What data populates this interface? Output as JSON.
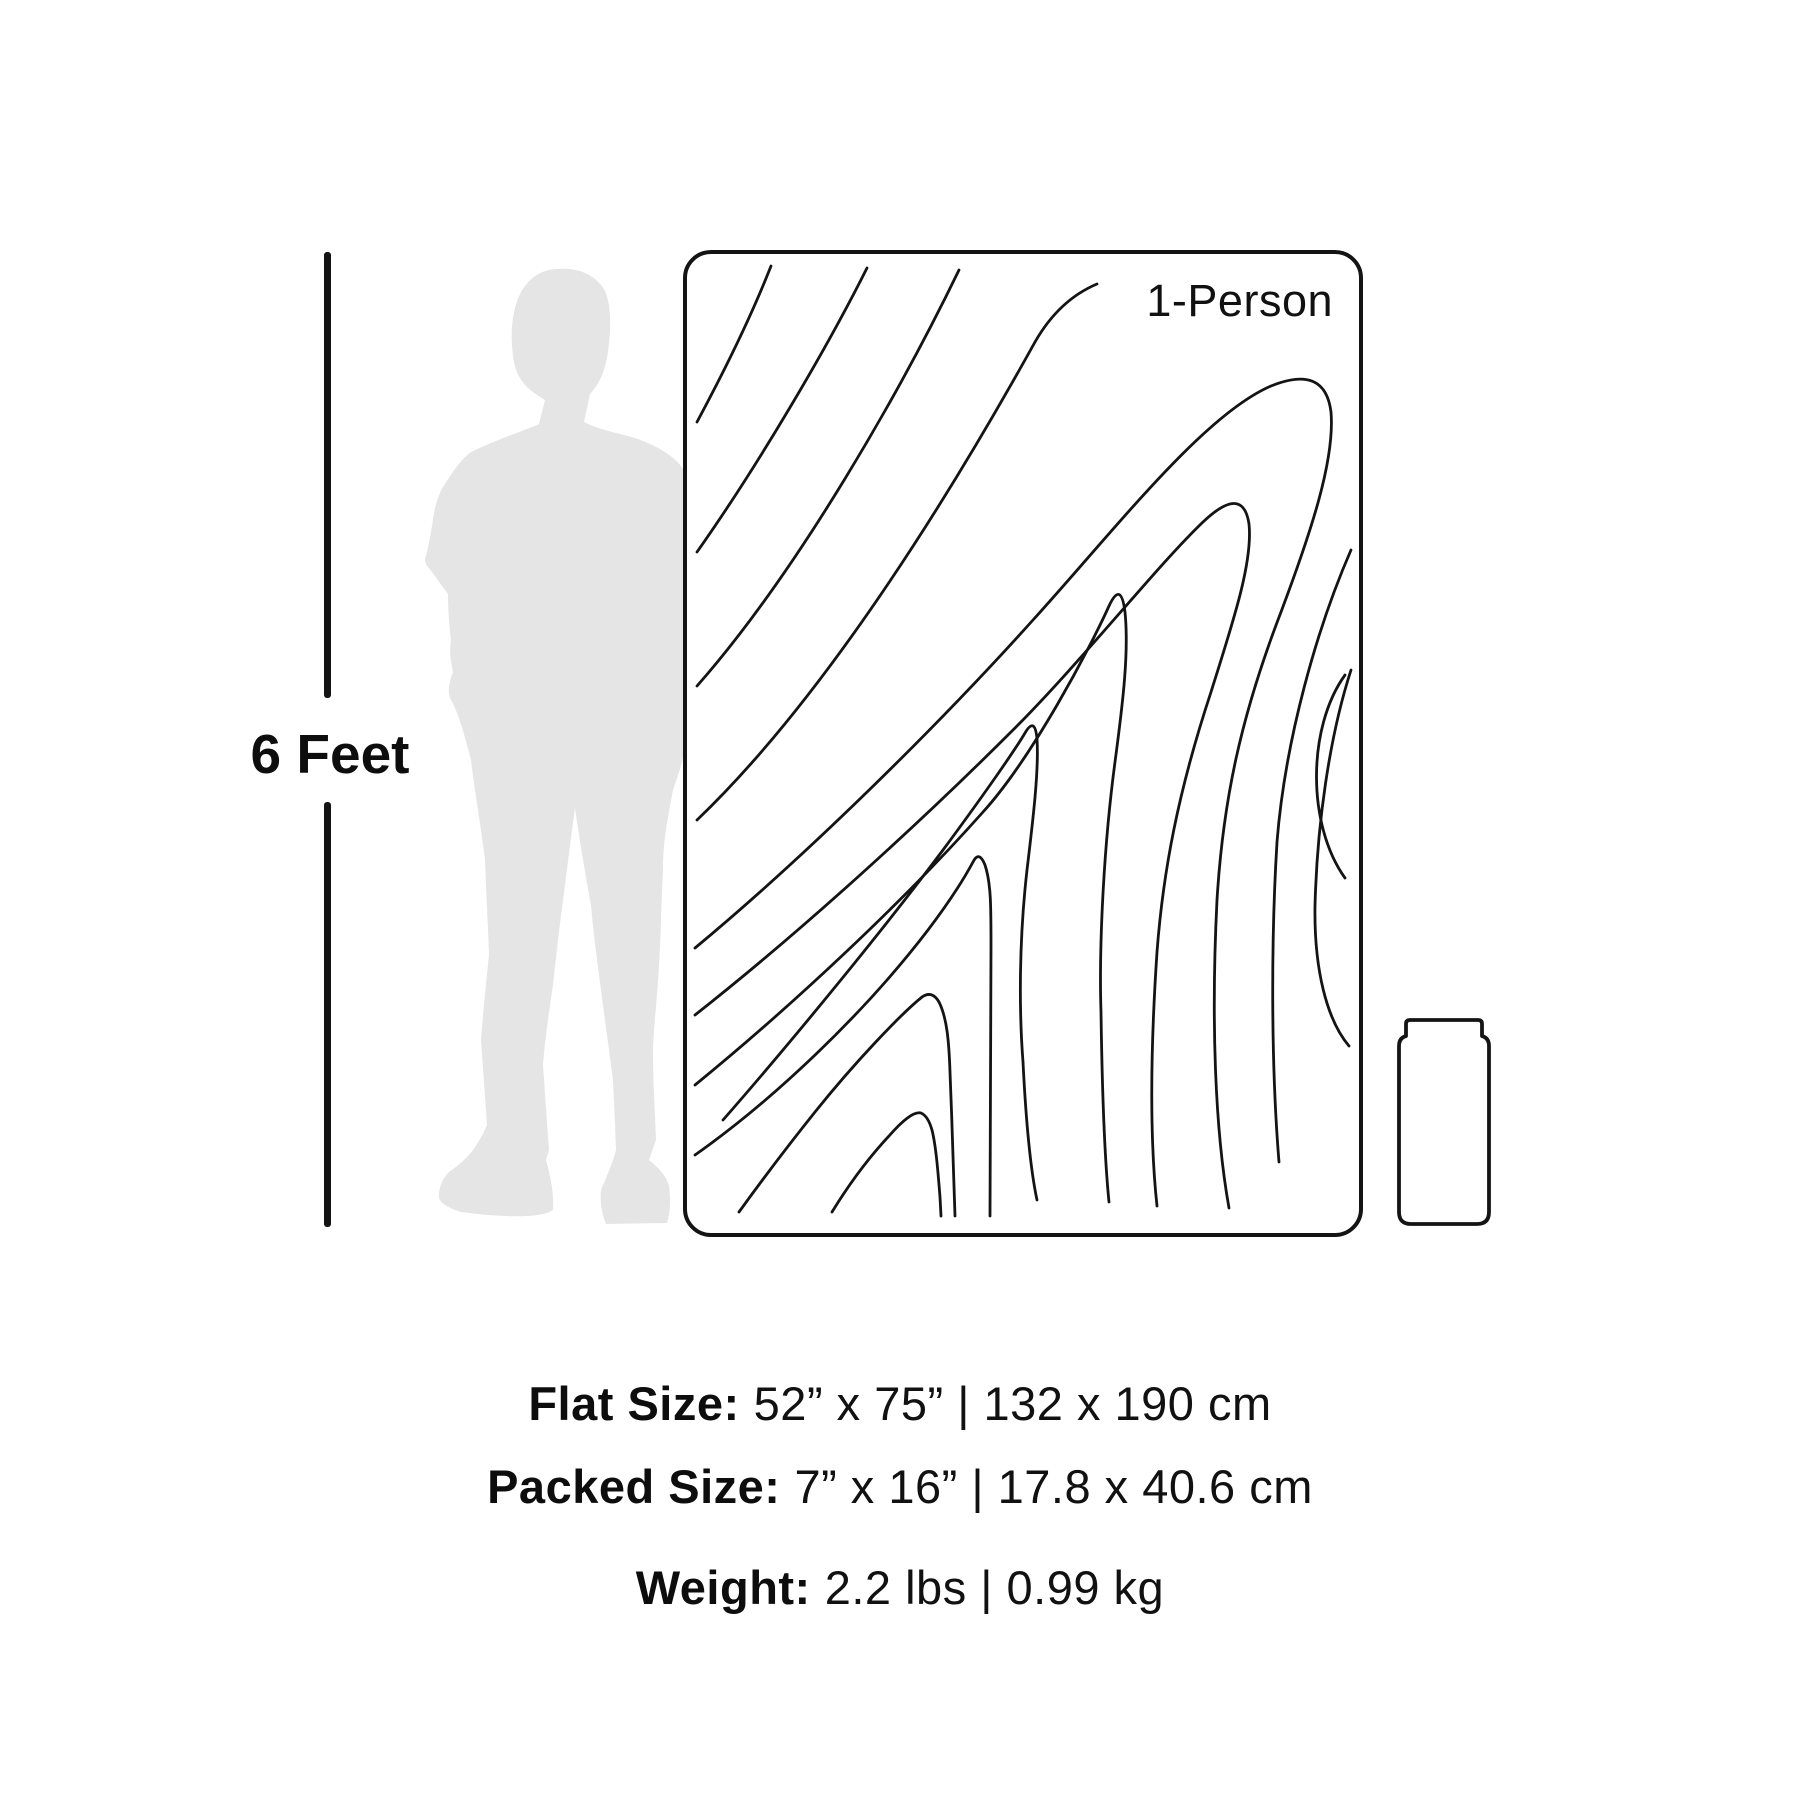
{
  "scale": {
    "label": "6 Feet"
  },
  "blanket": {
    "label": "1-Person"
  },
  "specs": [
    {
      "label": "Flat Size:",
      "value": "52” x 75” | 132 x 190 cm"
    },
    {
      "label": "Packed Size:",
      "value": "7” x 16” | 17.8 x 40.6 cm"
    },
    {
      "label": "Weight:",
      "value": "2.2 lbs | 0.99 kg"
    }
  ],
  "figures": {
    "person": "person-silhouette",
    "blanket": "topographic-blanket",
    "packed": "packed-roll"
  },
  "colors": {
    "ink": "#141414",
    "silhouette": "#e5e5e5",
    "background": "#ffffff"
  }
}
